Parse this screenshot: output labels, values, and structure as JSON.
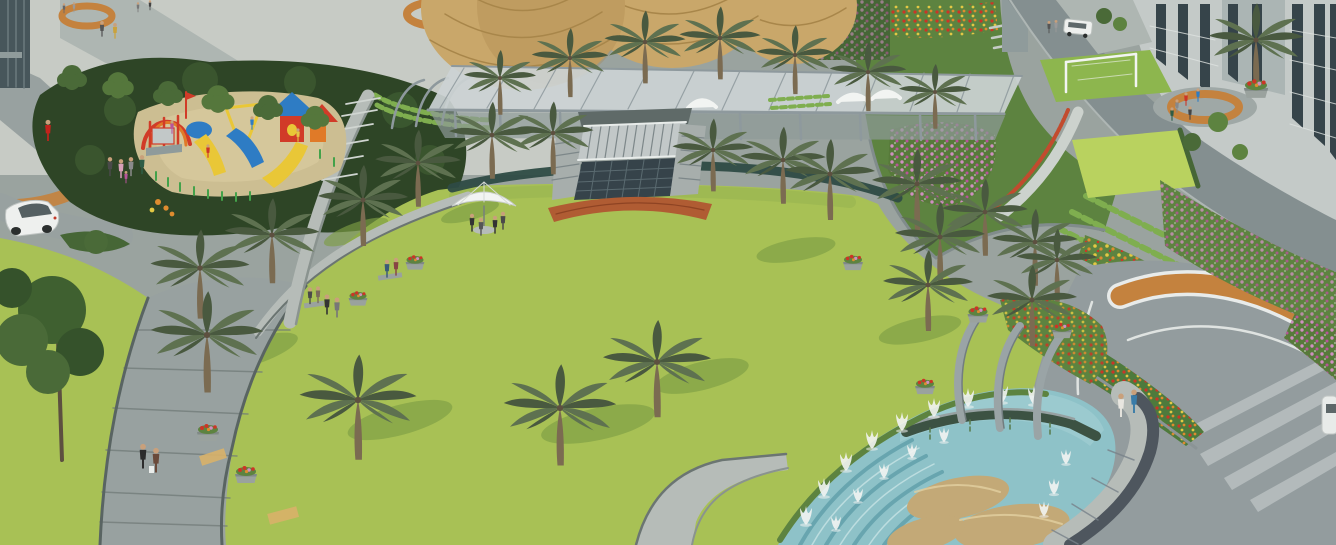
{
  "scene": {
    "title": "Aerial 3D architectural rendering of a residential township central landscape park",
    "description": "Large oval lawn ringed by palm trees with a children's playground, steel pergola with thatched domes, terraced flower gardens, apartment towers, curved walkways and a stepped fountain pool with rock boulders",
    "elements": [
      {
        "name": "central-lawn",
        "label": "Central oval lawn"
      },
      {
        "name": "playground",
        "label": "Children's playground with slides"
      },
      {
        "name": "pergola",
        "label": "Steel pergola canopy"
      },
      {
        "name": "thatched-domes",
        "label": "Thatched dome pavilions"
      },
      {
        "name": "amphitheater-skylight",
        "label": "Sunken skylight and steps"
      },
      {
        "name": "fountain-pool",
        "label": "Stepped fountain pool with jets and boulders"
      },
      {
        "name": "arch-pillars",
        "label": "Curved stone arch pillars"
      },
      {
        "name": "apartment-towers",
        "label": "Apartment tower facades"
      },
      {
        "name": "terraced-gardens",
        "label": "Terraced flower gardens"
      },
      {
        "name": "curved-walkways",
        "label": "Curved stone walkways"
      },
      {
        "name": "plaza",
        "label": "Entry plaza with orange paver circles"
      },
      {
        "name": "umbrella-seating",
        "label": "White umbrella cafe seating"
      },
      {
        "name": "white-car",
        "label": "White sedan"
      },
      {
        "name": "white-van",
        "label": "White van"
      },
      {
        "name": "pedestrians",
        "label": "People walking and sitting"
      }
    ]
  },
  "palette": {
    "lawn": "#a8c155",
    "lawnShade": "#7d9e45",
    "grassBright": "#b9d25f",
    "grassMid": "#8db64e",
    "plaza": "#c7cbc5",
    "plazaPath": "#aeb6b2",
    "pathGrey": "#98a1a0",
    "pathDark": "#7d8789",
    "curb": "#596462",
    "steel": "#c6ccce",
    "steelShadow": "#8e999d",
    "canopy": "#ccd3d4",
    "wallLight": "#b6bcb8",
    "wallMid": "#9aa29e",
    "wallDark": "#6b7572",
    "fence": "#2e4b45",
    "skylight": "#36434a",
    "water": "#8ec2c8",
    "waterDeep": "#5f9fa9",
    "waterLight": "#c2e0e2",
    "brick": "#b05c33",
    "paverOrange": "#c4823e",
    "paverTan": "#d8b169",
    "dome": "#c9a76a",
    "domeShade": "#a8864a",
    "foliageDark": "#2e4526",
    "foliageMid": "#466636",
    "leafGreen": "#5d8340",
    "shrubLight": "#7fae4f",
    "palmGreen": "#5e7150",
    "palmDark": "#49593f",
    "trunk": "#7b6b51",
    "trunkDark": "#5d5040",
    "sand": "#ccbe92",
    "boulder": "#c3a977",
    "playRed": "#d13b28",
    "playYellow": "#e9c737",
    "playBlue": "#2e7cc4",
    "playGreen": "#43a24a",
    "flowerPink": "#cf8fc0",
    "flowerMagenta": "#b8559a",
    "flowerRed": "#cc3526",
    "flowerOrange": "#df8c2f",
    "flowerYellow": "#e3c844",
    "building": "#c4cac8",
    "buildingDark": "#8f9b9b",
    "window": "#36444a",
    "white": "#f2f4f2",
    "granite": "#4e565e",
    "road": "#939c9e",
    "skin": "#c9a07b"
  }
}
